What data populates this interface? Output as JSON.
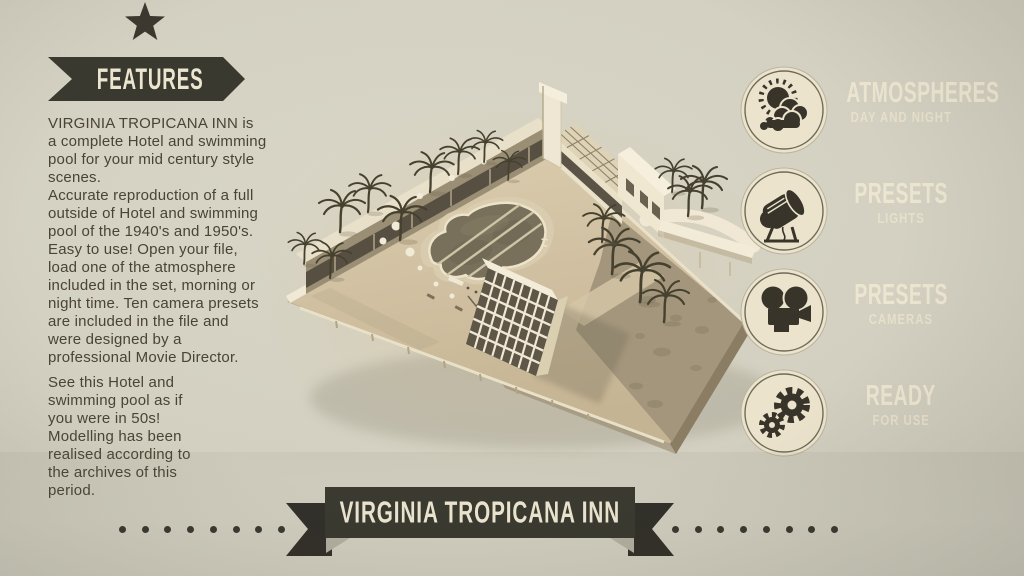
{
  "features_panel": {
    "ribbon_label": "FEATURES",
    "paragraph_1": "VIRGINIA TROPICANA INN is\na complete Hotel and swimming\npool for your mid century style\nscenes.\nAccurate reproduction of a full\noutside of Hotel and swimming\npool of the 1940's and 1950's.\nEasy to use! Open your file,\nload one of the atmosphere\nincluded in the set, morning or\nnight time. Ten camera presets\nare included in the file and\nwere designed by a\nprofessional Movie Director.",
    "paragraph_2": "See this Hotel and\nswimming pool as if\nyou were in 50s!\nModelling has been\nrealised according to\nthe archives of this\nperiod."
  },
  "feature_list": [
    {
      "icon": "sun-and-clouds-icon",
      "title": "ATMOSPHERES",
      "subtitle": "DAY AND NIGHT"
    },
    {
      "icon": "spotlight-icon",
      "title": "PRESETS",
      "subtitle": "LIGHTS"
    },
    {
      "icon": "movie-camera-icon",
      "title": "PRESETS",
      "subtitle": "CAMERAS"
    },
    {
      "icon": "gears-icon",
      "title": "READY",
      "subtitle": "FOR USE"
    }
  ],
  "banner": {
    "title": "VIRGINIA TROPICANA INN",
    "dots_per_side": 8
  },
  "illustration": {
    "description": "Sepia 3D render of a mid-century hotel lot with clover-shaped swimming pool, motel row, white tower and palm trees"
  },
  "colors": {
    "background": "#d3d0c1",
    "ink": "#3b392f",
    "cream": "#ece6d1",
    "sepia_ground": "#cfc0a3"
  }
}
